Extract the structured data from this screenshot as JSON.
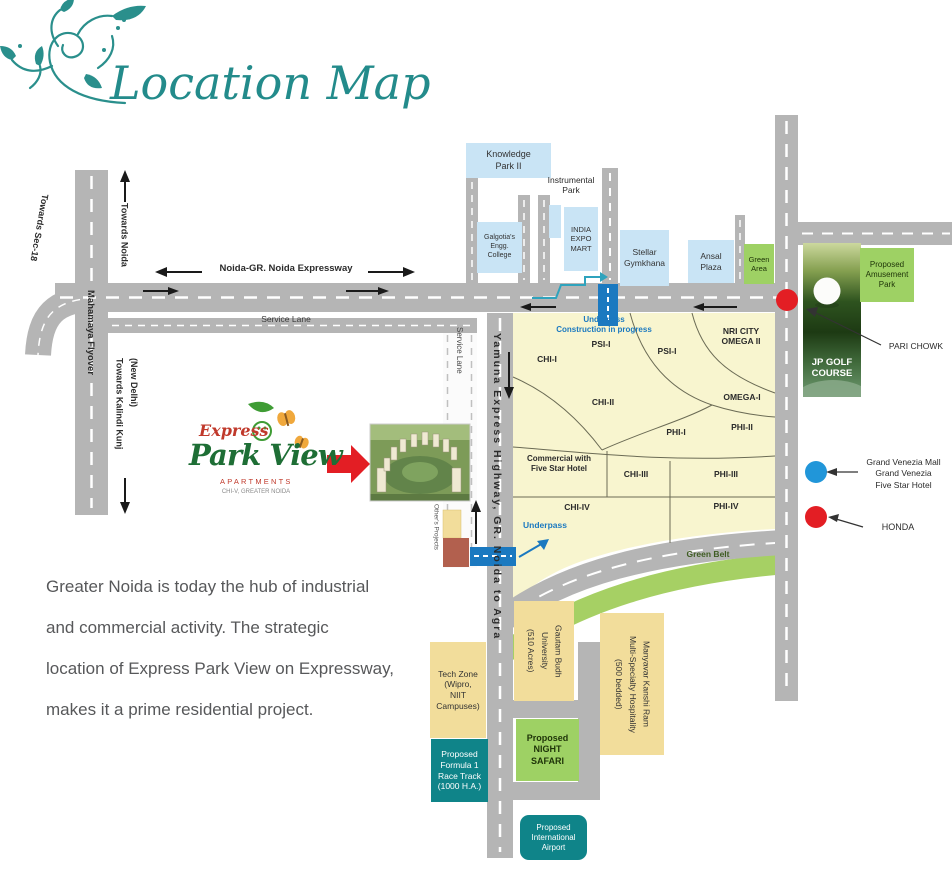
{
  "title": "Location Map",
  "logo": {
    "express": "Express",
    "name": "Park View",
    "apartments": "APARTMENTS",
    "location": "CHI-V, GREATER NOIDA"
  },
  "description": {
    "text": "Greater Noida is today the hub of industrial\nand commercial activity. The strategic\nlocation of Express Park View on Expressway,\nmakes it a prime residential project."
  },
  "roads": {
    "expressway_label": "Noida-GR. Noida Expressway",
    "service_lane": "Service Lane",
    "service_lane_vertical": "Service Lane",
    "mahamaya": "Mahamaya Flyover",
    "yamuna": "Yamuna Express Highway, GR. Noida to Agra",
    "towards_sec18": "Towards Sec-18",
    "towards_noida": "Towards Noida",
    "kalindi": "(New Delhi)\nTowards Kalindi Kunj"
  },
  "places": {
    "knowledge_park": "Knowledge\nPark II",
    "instrumental_park": "Instrumental\nPark",
    "galgotias": "Galgotia's\nEngg.\nCollege",
    "india_expo": "INDIA\nEXPO\nMART",
    "stellar": "Stellar\nGymkhana",
    "ansal": "Ansal\nPlaza",
    "green_area": "Green\nArea",
    "amusement": "Proposed\nAmusement\nPark",
    "jp_golf": "JP GOLF\nCOURSE",
    "pari_chowk": "PARI CHOWK",
    "grand_venezia": "Grand Venezia Mall\nGrand Venezia\nFive Star Hotel",
    "honda": "HONDA",
    "green_belt": "Green Belt",
    "tech_zone": "Tech Zone\n(Wipro,\nNIIT\nCampuses)",
    "formula1": "Proposed\nFormula 1\nRace Track\n(1000 H.A.)",
    "gautam": "Gautam Budh\nUniversity\n(510 Acres)",
    "night_safari": "Proposed\nNIGHT\nSAFARI",
    "manyavar": "Manyavar Kanshi Ram\nMulti-Specialty Hospitality\n(500 bedded)",
    "airport": "Proposed\nInternational\nAirport",
    "others_projects": "Other's Projects"
  },
  "sectors": {
    "psi1a": "PSI-I",
    "psi1b": "PSI-I",
    "chi1": "CHI-I",
    "chi2": "CHI-II",
    "chi3": "CHI-III",
    "chi4": "CHI-IV",
    "phi1": "PHI-I",
    "phi2": "PHI-II",
    "phi3": "PHI-III",
    "phi4": "PHI-IV",
    "omega1": "OMEGA-I",
    "nri": "NRI CITY\nOMEGA II",
    "commercial": "Commercial with\nFive Star Hotel"
  },
  "annotations": {
    "underpass_construction": "Underpass\nConstruction in progress",
    "underpass": "Underpass"
  },
  "colors": {
    "title_teal": "#238b8b",
    "road_gray": "#b5b5b5",
    "sector_yellow": "#f8f5cf",
    "box_yellow": "#f2dd9b",
    "box_lightblue": "#c9e4f5",
    "box_green": "#9ed164",
    "box_teal": "#0f8489",
    "underpass_blue": "#1b79c0",
    "marker_red": "#e31e24",
    "marker_blue": "#2196d9",
    "green_belt": "#a6d064",
    "logo_red": "#c0392b",
    "logo_green": "#1e6e35",
    "text_gray": "#57585a"
  }
}
